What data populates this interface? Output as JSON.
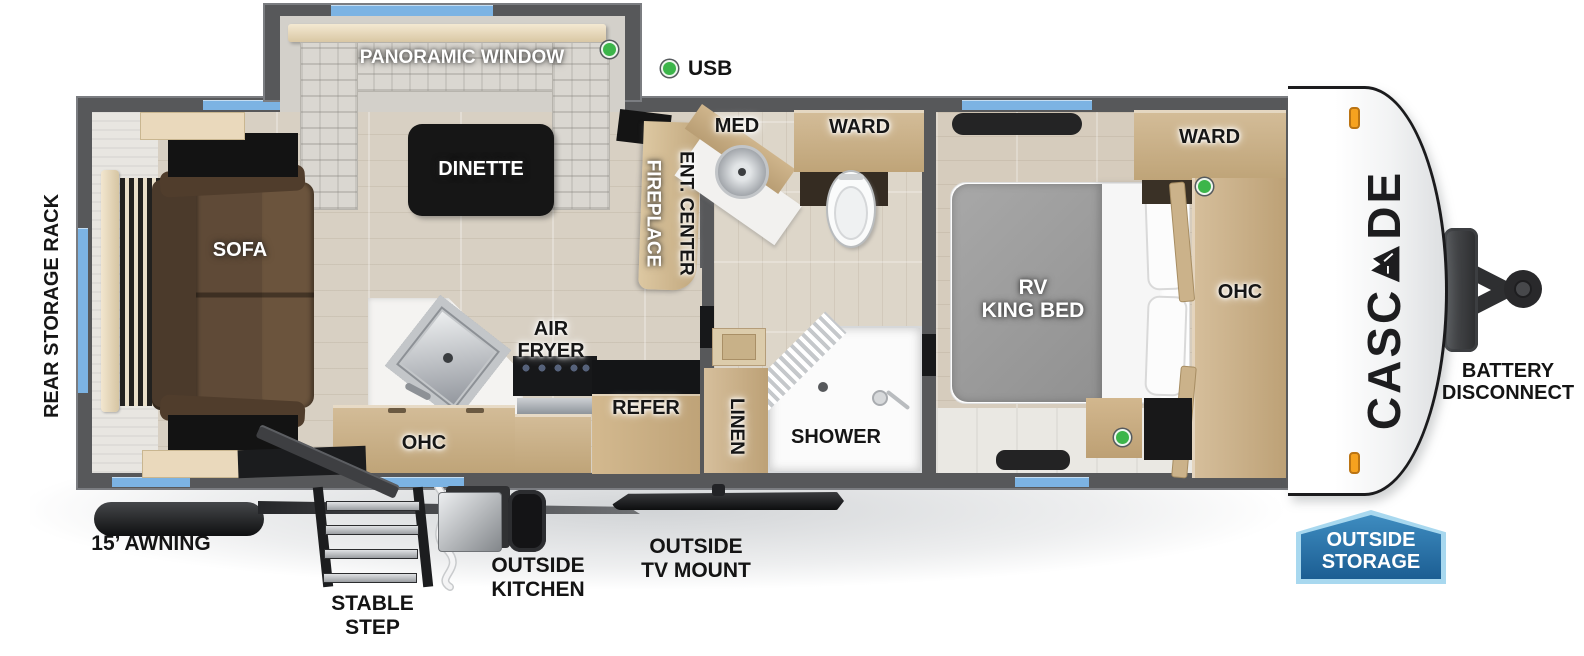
{
  "colors": {
    "wall": "#57585a",
    "window_blue": "#7cb3e3",
    "usb_green": "#3cb54a",
    "marker_orange": "#f6a21f",
    "badge_border": "#a8d8ef",
    "badge_fill_top": "#3e8cc0",
    "badge_fill_bottom": "#1c5e93",
    "cabinet_tan": "#c9ae85",
    "sofa_brown": "#5f4a37",
    "bed_gray": "#9c9c9c",
    "table_black": "#161616"
  },
  "brand": {
    "prefix": "CASC",
    "logo_letter": "A",
    "suffix": "DE",
    "full": "CASCADE"
  },
  "legend": {
    "usb": "USB"
  },
  "slideout": {
    "window_label": "PANORAMIC WINDOW",
    "table_label": "DINETTE"
  },
  "living": {
    "sofa": "SOFA",
    "rear_rack": "REAR STORAGE RACK",
    "fireplace": "FIREPLACE",
    "ent_center": "ENT. CENTER"
  },
  "kitchen": {
    "air_fryer_line1": "AIR",
    "air_fryer_line2": "FRYER",
    "ohc": "OHC",
    "refer": "REFER"
  },
  "bathroom": {
    "med": "MED",
    "ward": "WARD",
    "linen": "LINEN",
    "shower": "SHOWER"
  },
  "bedroom": {
    "bed_line1": "RV",
    "bed_line2": "KING BED",
    "ward": "WARD",
    "ohc": "OHC"
  },
  "exterior": {
    "awning": "15’ AWNING",
    "stable_step": "STABLE STEP",
    "outside_kitchen": "OUTSIDE KITCHEN",
    "tv_line1": "OUTSIDE",
    "tv_line2": "TV MOUNT",
    "battery_line1": "BATTERY",
    "battery_line2": "DISCONNECT",
    "storage_line1": "OUTSIDE",
    "storage_line2": "STORAGE"
  }
}
